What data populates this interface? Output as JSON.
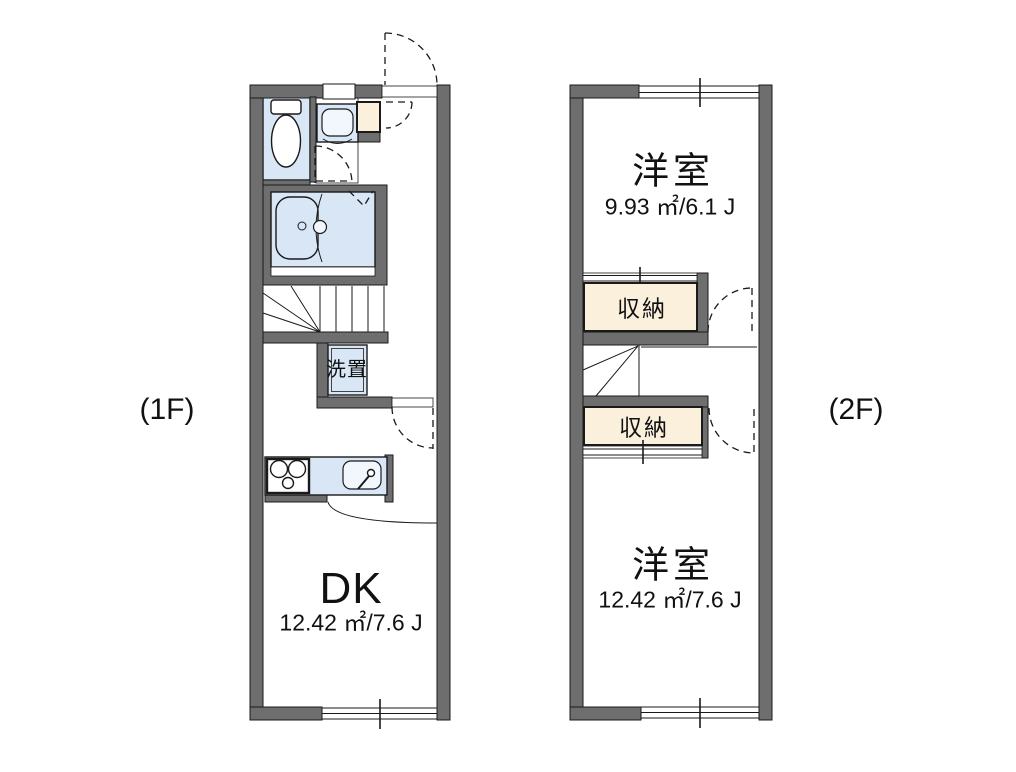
{
  "floors": {
    "f1": {
      "label": "(1F)",
      "rooms": {
        "dk": {
          "name": "DK",
          "area": "12.42 ㎡/7.6 J"
        },
        "laundry": {
          "name": "洗置"
        }
      }
    },
    "f2": {
      "label": "(2F)",
      "rooms": {
        "bedroom1": {
          "name": "洋室",
          "area": "9.93 ㎡/6.1 J"
        },
        "storage1": {
          "name": "収納"
        },
        "storage2": {
          "name": "収納"
        },
        "bedroom2": {
          "name": "洋室",
          "area": "12.42 ㎡/7.6 J"
        }
      }
    }
  },
  "colors": {
    "wall": "#6e6e6e",
    "outline": "#1a1a1a",
    "fixture": "#d9e6f6",
    "fixture-light": "#f2f7fd",
    "storage": "#faf0db",
    "bg": "#ffffff",
    "text": "#111111"
  }
}
